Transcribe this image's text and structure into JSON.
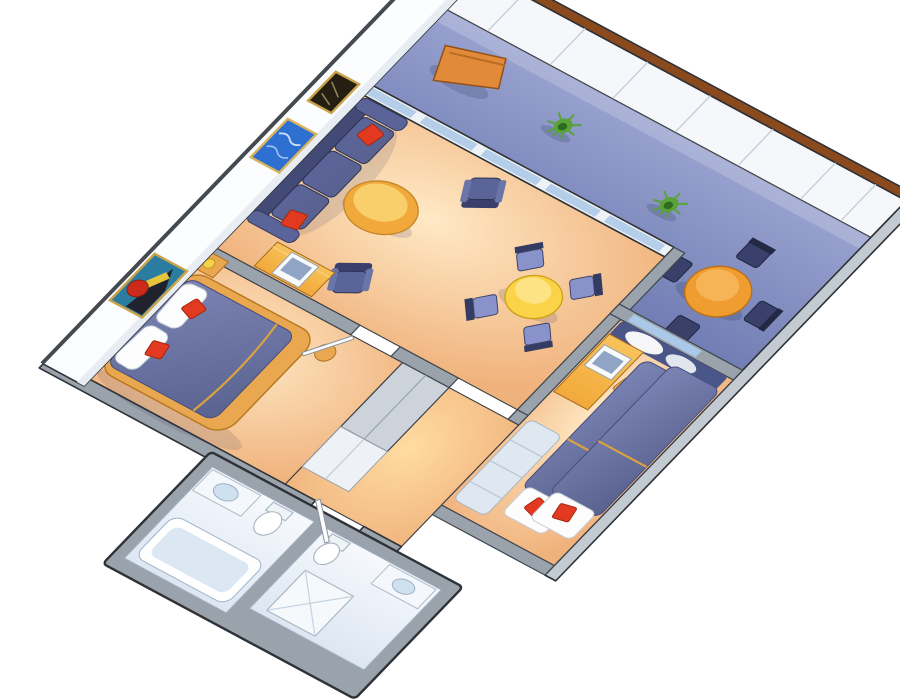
{
  "scene": {
    "type": "3d-cutaway-floor-plan",
    "subject": "two-bedroom suite with private balcony",
    "orientation": "rotated-diagonal",
    "background": "#ffffff"
  },
  "palette": {
    "wall_outline": "#2e3237",
    "wall_top": "#9aa2ab",
    "wall_top_light": "#c3cad2",
    "wall_face_white": "#fcfdfe",
    "wall_shade": "#e7edf3",
    "railing_cap_brown": "#8a4a1e",
    "railing_face": "#f5f7fa",
    "deck_blue_light": "#99a3d0",
    "deck_blue": "#8691c4",
    "deck_blue_dark": "#6f7bb2",
    "carpet_glow": "#ffe9c6",
    "carpet_peach": "#f0b27c",
    "corridor_glow": "#ffdca2",
    "sofa_navy": "#5a6499",
    "sofa_navy_deep": "#424a75",
    "chair_navy_dark": "#39406a",
    "chair_periwinkle": "#8a92cc",
    "cushion_red": "#e23a20",
    "bed_slate": "#7b84b4",
    "bed_slate_dark": "#59628f",
    "bed_trim_gold": "#d9a23f",
    "pillow_white": "#fdfdfe",
    "wood_light": "#f7c35a",
    "wood_orange": "#f2a93b",
    "wood_frame": "#e9a74f",
    "table_yellow": "#fbd348",
    "table_balcony_orange": "#ef9c30",
    "lounger_orange": "#e18a3a",
    "plant_green_dark": "#2f6b1e",
    "plant_green": "#59a23a",
    "glass_blue": "#aac8e8",
    "curtain_navy": "#4a5588",
    "closet_gray": "#ccd3db",
    "closet_white": "#eef1f5",
    "bench_pale": "#dfe7f1",
    "bath_floor_light": "#f6f9fd",
    "bath_floor": "#dde6f2",
    "fixture_white": "#ffffff",
    "fixture_inner": "#dbe8f4",
    "tv_white": "#f8fafb",
    "tv_screen": "#90a5c6",
    "art_frame_gold": "#c9a24a",
    "art_ocean_blue": "#2e6fd2",
    "art_small_dark": "#241f12",
    "art_master_teal": "#2a7da1",
    "art_master_red": "#cc2a1a",
    "art_master_yellow": "#e6c43b",
    "door_white": "#fbfcfd"
  },
  "rooms": {
    "balcony": {
      "label": "balcony",
      "furniture": [
        "lounge-chair",
        "potted-plant",
        "potted-plant",
        "round-dining-table",
        "dining-chair",
        "dining-chair",
        "dining-chair",
        "dining-chair"
      ]
    },
    "living_room": {
      "label": "living room",
      "furniture": [
        "sofa",
        "red-throw-pillow",
        "red-throw-pillow",
        "coffee-table",
        "armchair",
        "armchair",
        "round-dining-table",
        "dining-chair",
        "dining-chair",
        "dining-chair",
        "dining-chair",
        "tv-cabinet",
        "television"
      ]
    },
    "master_bedroom": {
      "label": "master bedroom",
      "furniture": [
        "double-bed",
        "pillow",
        "pillow",
        "red-throw-pillow",
        "red-throw-pillow",
        "nightstand",
        "lamp",
        "stool",
        "wardrobe",
        "closet"
      ]
    },
    "second_bedroom": {
      "label": "second bedroom",
      "furniture": [
        "twin-bed",
        "twin-bed",
        "desk",
        "television",
        "desk-chair",
        "drawer-bench",
        "window-curtains"
      ]
    },
    "master_bathroom": {
      "label": "master bathroom",
      "furniture": [
        "bathtub",
        "sink",
        "toilet"
      ]
    },
    "second_bathroom": {
      "label": "second bathroom",
      "furniture": [
        "shower",
        "sink",
        "toilet"
      ]
    },
    "hallway": {
      "label": "entry hallway",
      "furniture": [
        "entry-door",
        "bedroom-door"
      ]
    }
  },
  "wall_art": {
    "count": 3,
    "items": [
      "small-framed-art",
      "ocean-painting",
      "abstract-painting"
    ]
  }
}
